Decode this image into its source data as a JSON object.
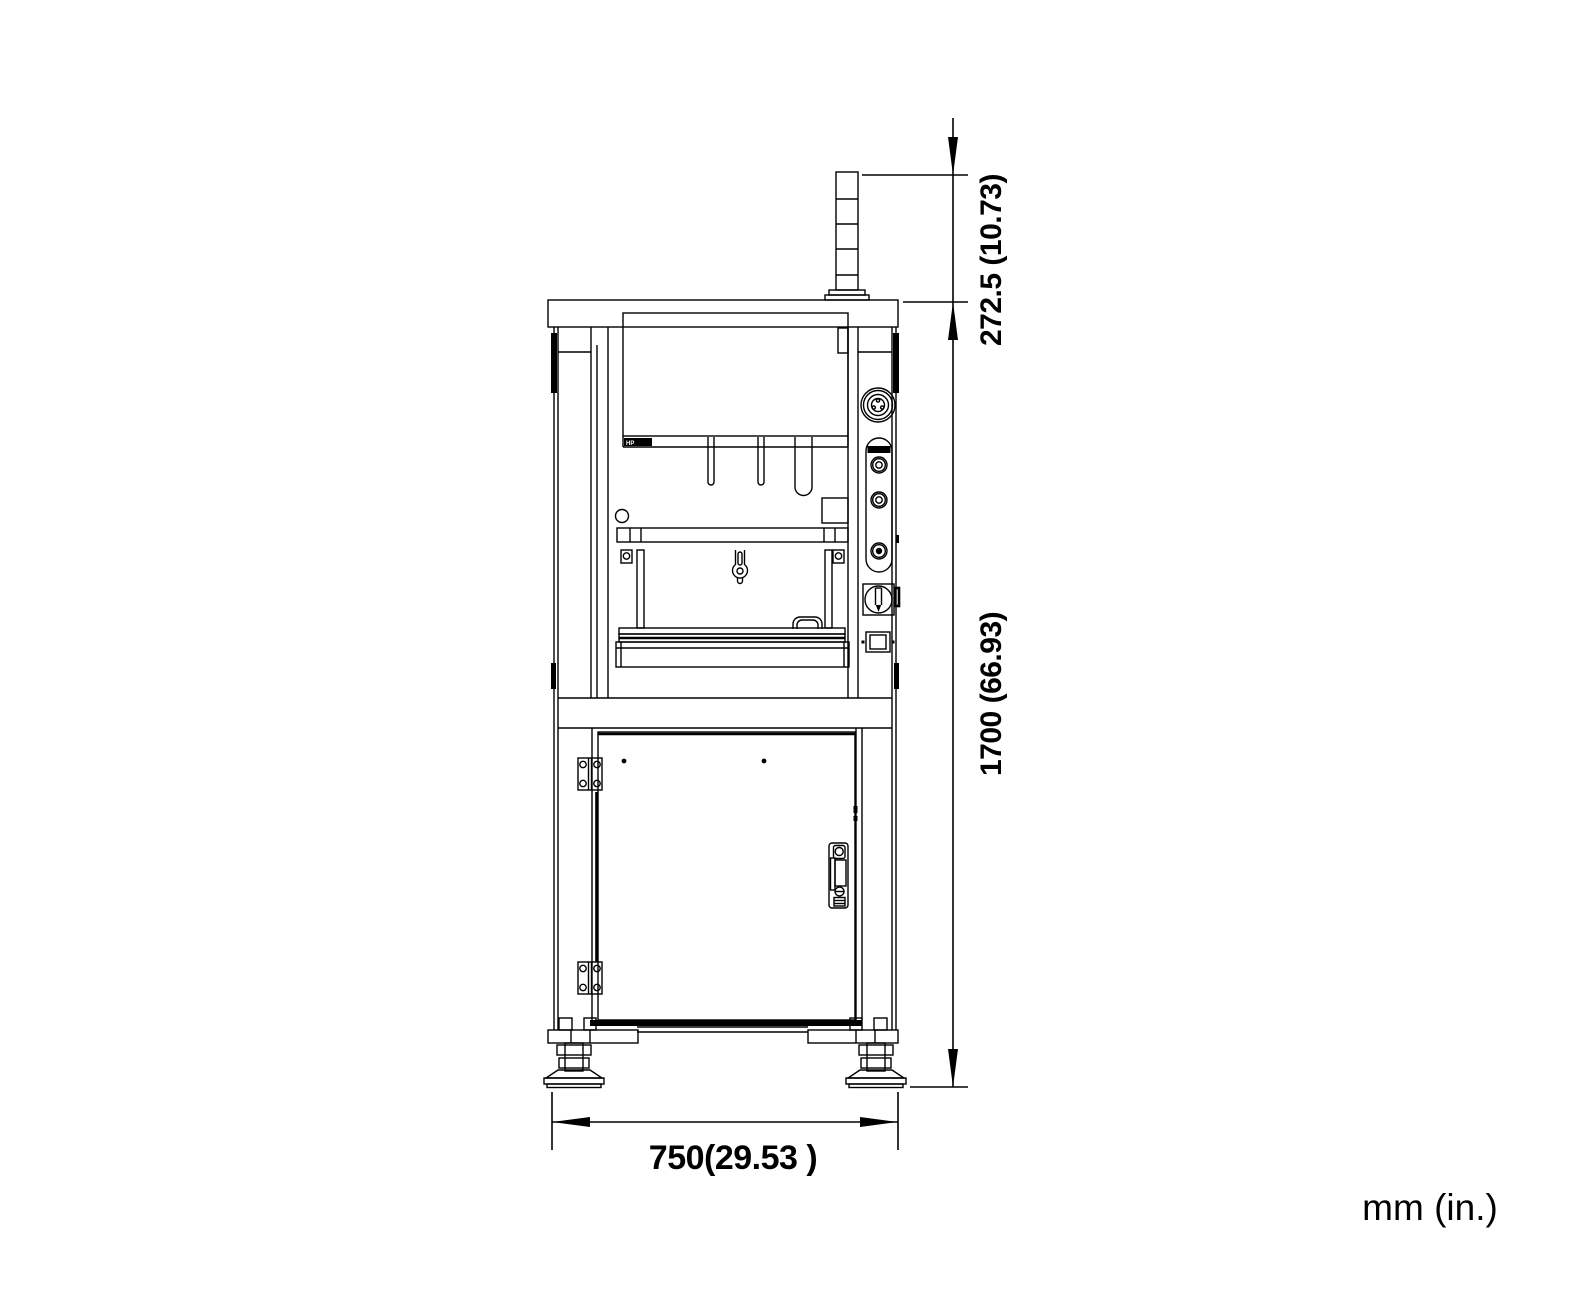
{
  "labels": {
    "tower_height": "272.5 (10.73)",
    "machine_height": "1700 (66.93)",
    "machine_width": "750(29.53 )",
    "units": "mm (in.)"
  },
  "machine": {
    "head_label": "HP"
  },
  "colors": {
    "line": "#000000",
    "background": "#ffffff"
  }
}
